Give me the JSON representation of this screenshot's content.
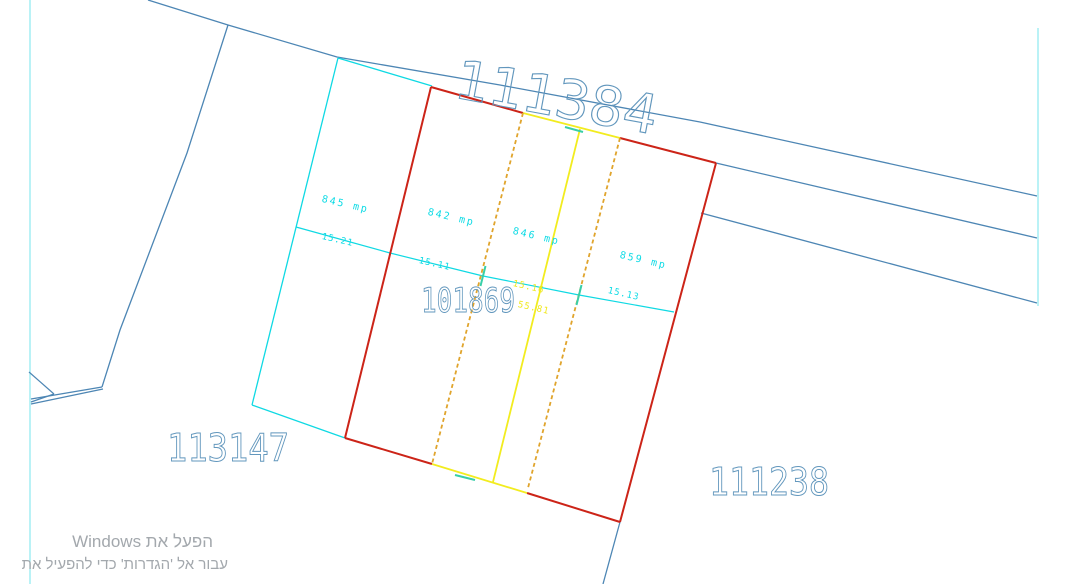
{
  "drawing": {
    "road_parcel_number": "111384",
    "center_parcel_number": "101869",
    "left_parcel_number": "113147",
    "right_parcel_number": "111238",
    "area_labels": [
      {
        "text": "845 mp"
      },
      {
        "text": "842 mp"
      },
      {
        "text": "846 mp"
      },
      {
        "text": "859 mp"
      }
    ],
    "dimension_labels": [
      {
        "text": "15.21"
      },
      {
        "text": "15.11"
      },
      {
        "text": "15.16"
      },
      {
        "text": "55.81"
      },
      {
        "text": "15.13"
      }
    ],
    "colors": {
      "boundary_blue": "#4d86b4",
      "parcel_number_blue": "#6297bd",
      "cyan": "#0fd9e3",
      "pale_cyan": "#8ceaf0",
      "red": "#cc2418",
      "yellow": "#f2ec1f",
      "orange": "#e0a42c",
      "green_tick": "#38cfa8",
      "watermark_gray": "#a3a8ad",
      "background": "#ffffff"
    }
  },
  "watermark": {
    "line1": "הפעל את Windows",
    "line2": "עבור אל 'הגדרות' כדי להפעיל את"
  }
}
